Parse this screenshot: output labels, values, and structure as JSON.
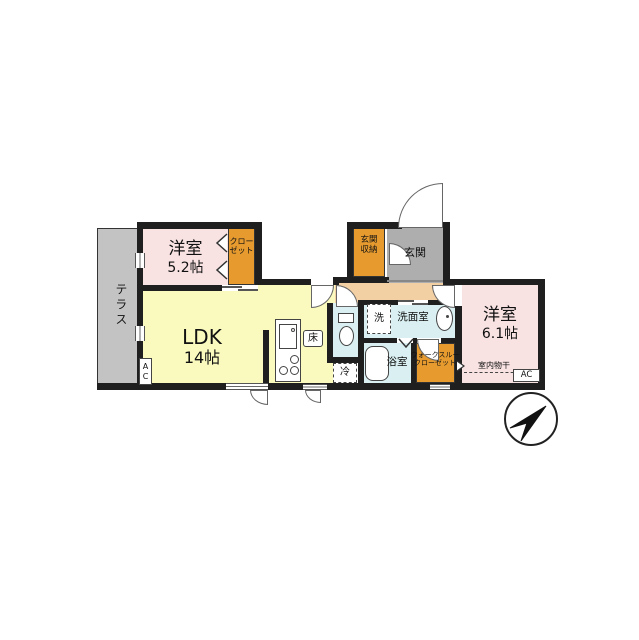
{
  "colors": {
    "wall": "#1f1f1f",
    "bedroom": "#f8e2e2",
    "ldk": "#fafabe",
    "hallway": "#f3d0a4",
    "closet": "#e79b2f",
    "entry": "#aeaeae",
    "terrace": "#c3c3c3",
    "wet": "#d9eff1"
  },
  "rooms": {
    "terrace": {
      "label": "テラス"
    },
    "bedroom1": {
      "name": "洋室",
      "size": "5.2帖"
    },
    "closet": {
      "line1": "クロー",
      "line2": "ゼット"
    },
    "ldk": {
      "name": "LDK",
      "size": "14帖"
    },
    "entry_storage": {
      "line1": "玄関",
      "line2": "収納"
    },
    "entry": {
      "label": "玄関"
    },
    "washroom": {
      "label": "洗面室"
    },
    "bathroom": {
      "label": "浴室"
    },
    "wtc": {
      "line1": "ウォークスルー",
      "line2": "クローゼット"
    },
    "bedroom2": {
      "name": "洋室",
      "size": "6.1帖"
    }
  },
  "fixtures": {
    "washer": "洗",
    "fridge": "冷",
    "floor_storage": "床",
    "indoor_drying": "室内物干",
    "ac_left_top": "A",
    "ac_left_bottom": "C",
    "ac_right": "AC"
  }
}
